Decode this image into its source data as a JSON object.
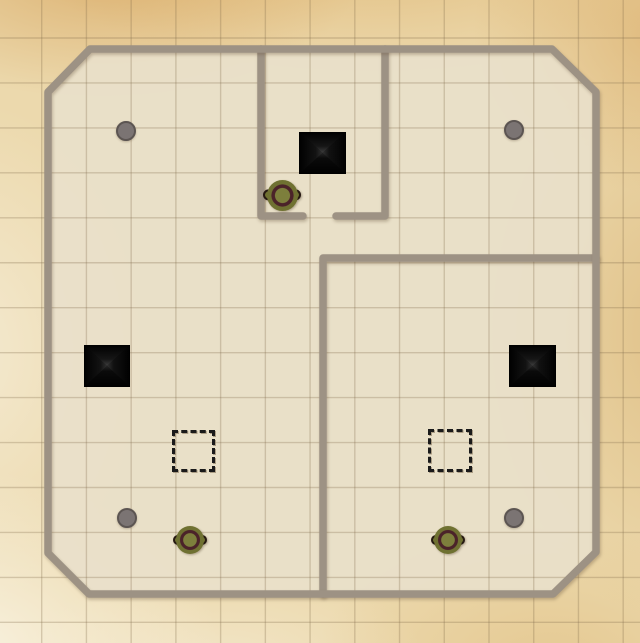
{
  "canvas": {
    "width": 640,
    "height": 643
  },
  "palette": {
    "parchment": "#ecd9ad",
    "floor": "#e9e0cb",
    "wall": "#9d9284",
    "gridLine": "rgba(125,104,72,0.28)",
    "zoneColor": "#1a1a1a",
    "dotFill": "#7b7473",
    "dotEdge": "#5c5552",
    "tokenOlive": "#6f7131",
    "tokenCenter": "#7d7f3c",
    "tokenRing": "#4b2329",
    "tokenEdge": "#261911",
    "pyramidDark": "#000000",
    "pyramidLight": "#ffffff"
  },
  "grid": {
    "offset_x": 41.7,
    "offset_y": 38,
    "spacing_x": 44.73,
    "spacing_y": 44.95,
    "line_width": 1.4
  },
  "walls": {
    "thickness": 7.5,
    "floor_opacity": 0.9,
    "outer_points": "90,49 552,49 596,92 596,552 553,594 89,594 48,553 48,92",
    "inner": [
      {
        "id": "north-room-west",
        "d": "M 261,49 L 261,216 L 303,216"
      },
      {
        "id": "north-room-east",
        "d": "M 385,49 L 385,216 L 336,216"
      },
      {
        "id": "southeast-room",
        "d": "M 596,258 L 323,258 L 323,594"
      }
    ]
  },
  "objects": {
    "pyramids": [
      {
        "id": "north",
        "x": 299,
        "y": 132,
        "w": 47,
        "h": 42
      },
      {
        "id": "west",
        "x": 84,
        "y": 345,
        "w": 46,
        "h": 42
      },
      {
        "id": "east",
        "x": 509,
        "y": 345,
        "w": 47,
        "h": 42
      }
    ],
    "zones": [
      {
        "id": "west",
        "x": 172,
        "y": 430,
        "w": 43,
        "h": 42
      },
      {
        "id": "east",
        "x": 428,
        "y": 429,
        "w": 44,
        "h": 43
      }
    ],
    "dot_diameter": 20,
    "dots": [
      {
        "id": "northwest",
        "cx": 126,
        "cy": 131
      },
      {
        "id": "northeast",
        "cx": 514,
        "cy": 130
      },
      {
        "id": "southwest",
        "cx": 127,
        "cy": 518
      },
      {
        "id": "southeast",
        "cx": 514,
        "cy": 518
      }
    ],
    "tokens": [
      {
        "id": "north",
        "cx": 282,
        "cy": 195,
        "d": 31
      },
      {
        "id": "southwest",
        "cx": 190,
        "cy": 540,
        "d": 28
      },
      {
        "id": "southeast",
        "cx": 448,
        "cy": 540,
        "d": 28
      }
    ]
  }
}
